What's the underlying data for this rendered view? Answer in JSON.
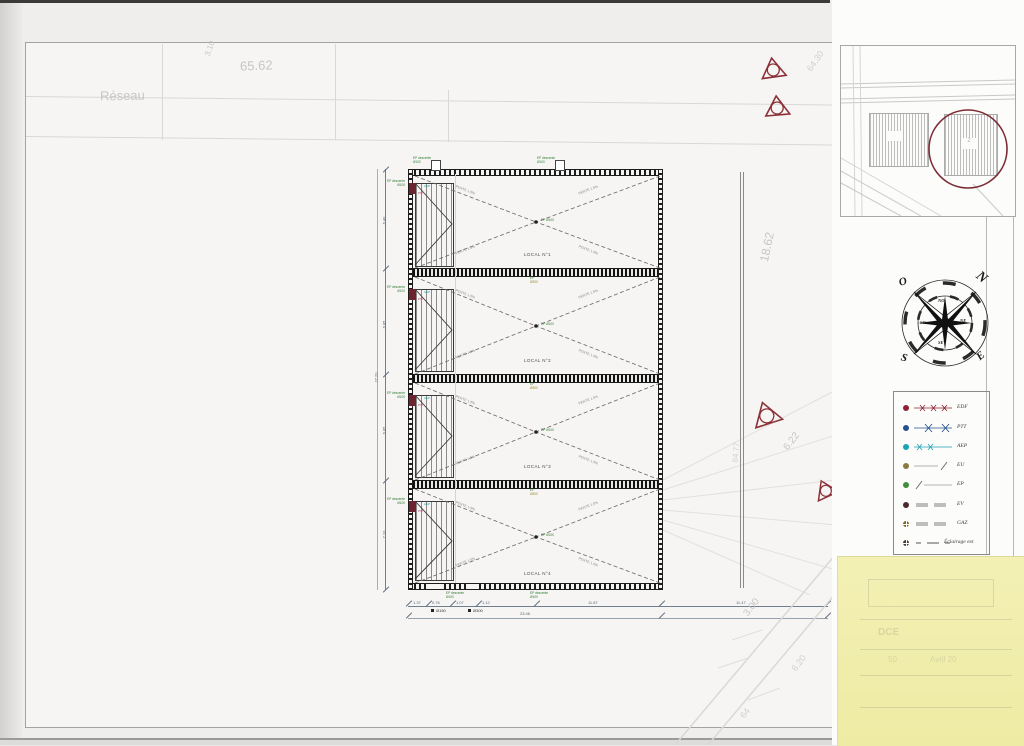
{
  "site": {
    "dim_top": "65.62",
    "dim_small_top": "3.10",
    "road_label": "Réseau",
    "dim_right": "18.62",
    "dim_fence": "84.77",
    "dim_622": "6.22",
    "dim_300": "3.00",
    "dim_620": "6.20",
    "dim_64": "64",
    "dim_6430": "64.30",
    "dim_9427": "94.27"
  },
  "plan": {
    "slope_label": "PENTE 1.5%",
    "drain_label": "EP Ø100",
    "strip_note_1": "EP",
    "strip_note_2": "Ø300",
    "ann_ep_1": "EP descente",
    "ann_ep_2": "Ø100",
    "ann_ptt": "PTT",
    "ann_aep": "AEP",
    "bays": [
      {
        "label": "LOCAL N°1"
      },
      {
        "label": "LOCAL N°2"
      },
      {
        "label": "LOCAL N°3"
      },
      {
        "label": "LOCAL N°4"
      }
    ]
  },
  "dims": {
    "left_bays": [
      "6.40",
      "6.85",
      "6.85",
      "7.10"
    ],
    "left_total": "27.20",
    "bottom_row1": [
      "1.37",
      "0.76",
      "1.07",
      "1.12",
      "11.87"
    ],
    "bottom_right": "11.47",
    "bottom_total": "23.46",
    "marker_1": "Ø150",
    "marker_2": "Ø300"
  },
  "compass": {
    "n": "N",
    "s": "S",
    "e": "E",
    "o": "O",
    "no": "NO",
    "ne": "NE",
    "so": "SO",
    "se": "SE"
  },
  "legend": {
    "items": [
      {
        "label": "EDF",
        "color": "#8c2332"
      },
      {
        "label": "PTT",
        "color": "#27508f"
      },
      {
        "label": "AEP",
        "color": "#1ba3b5"
      },
      {
        "label": "EU",
        "color": "#8a7a40"
      },
      {
        "label": "EP",
        "color": "#3f8f3f"
      },
      {
        "label": "EV",
        "color": "#4a2a2a"
      },
      {
        "label": "GAZ",
        "color": "#7a6a1f"
      },
      {
        "label": "Éclairage ext",
        "color": "#4a3a2a"
      }
    ]
  },
  "inset": {
    "building_label": "2"
  },
  "note": {
    "ghost_dce": "DCE",
    "ghost_scale": "50",
    "ghost_date": "Avril 20"
  },
  "colors": {
    "accent_red": "#8c3038",
    "sticky": "#f2efad",
    "dim_blue": "#55687a"
  }
}
